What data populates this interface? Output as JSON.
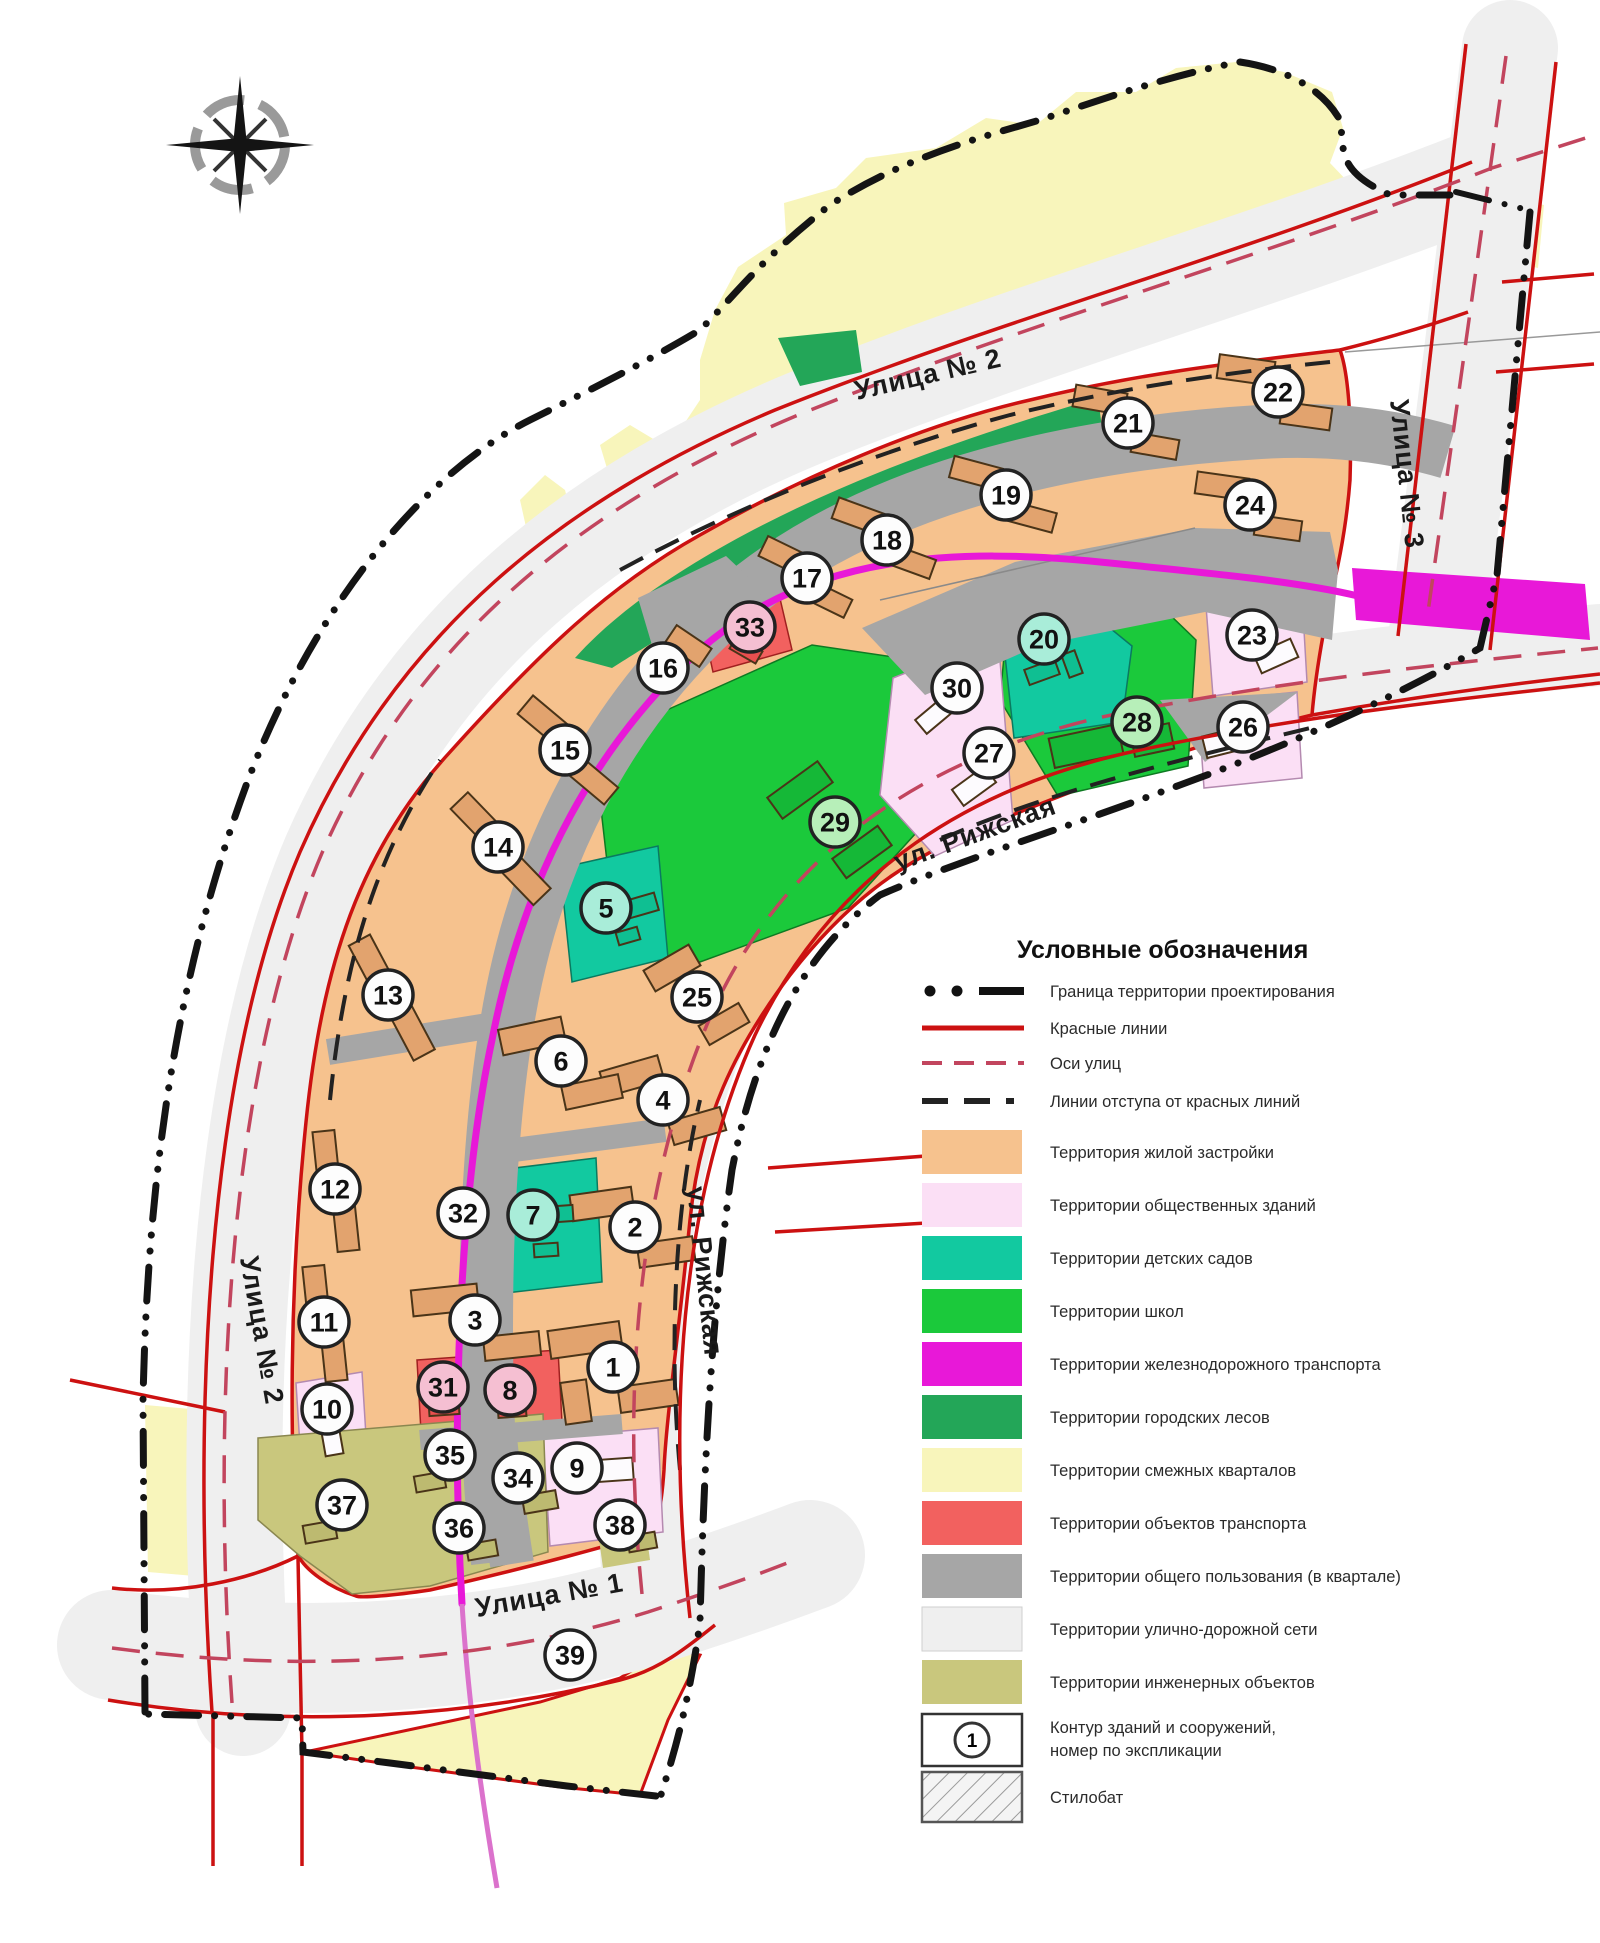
{
  "page": {
    "type": "urban-planning-scheme"
  },
  "colors": {
    "red_line": "#CC1111",
    "street_axis": "#C2455E",
    "boundary": "#141414",
    "residential": "#F6C28E",
    "public_buildings": "#FBDFF5",
    "kindergartens": "#12C9A0",
    "schools": "#1BC93B",
    "railway": "#E818D8",
    "urban_forests": "#23A658",
    "adjacent_blocks": "#F8F5BB",
    "transport_objects": "#F2615F",
    "common_use": "#A6A6A6",
    "street_network": "#EFEFEF",
    "engineering": "#C9C77D"
  },
  "map": {
    "street_labels": [
      {
        "text": "Улица № 2",
        "x": 930,
        "y": 383,
        "rot": -13
      },
      {
        "text": "Улица № 3",
        "x": 1398,
        "y": 475,
        "rot": 84
      },
      {
        "text": "ул. Рижская",
        "x": 978,
        "y": 842,
        "rot": -20
      },
      {
        "text": "ул. Рижская",
        "x": 696,
        "y": 1272,
        "rot": 84
      },
      {
        "text": "Улица № 2",
        "x": 253,
        "y": 1332,
        "rot": 80
      },
      {
        "text": "Улица № 1",
        "x": 551,
        "y": 1604,
        "rot": -10
      }
    ],
    "blocks": [
      {
        "n": "1",
        "x": 613,
        "y": 1367,
        "fill": "w"
      },
      {
        "n": "2",
        "x": 635,
        "y": 1227,
        "fill": "w"
      },
      {
        "n": "3",
        "x": 475,
        "y": 1320,
        "fill": "w"
      },
      {
        "n": "4",
        "x": 663,
        "y": 1100,
        "fill": "w"
      },
      {
        "n": "5",
        "x": 606,
        "y": 908,
        "fill": "t"
      },
      {
        "n": "6",
        "x": 561,
        "y": 1061,
        "fill": "w"
      },
      {
        "n": "7",
        "x": 533,
        "y": 1215,
        "fill": "t"
      },
      {
        "n": "8",
        "x": 510,
        "y": 1390,
        "fill": "p"
      },
      {
        "n": "9",
        "x": 577,
        "y": 1468,
        "fill": "w"
      },
      {
        "n": "10",
        "x": 327,
        "y": 1409,
        "fill": "w"
      },
      {
        "n": "11",
        "x": 324,
        "y": 1322,
        "fill": "w"
      },
      {
        "n": "12",
        "x": 335,
        "y": 1189,
        "fill": "w"
      },
      {
        "n": "13",
        "x": 388,
        "y": 995,
        "fill": "w"
      },
      {
        "n": "14",
        "x": 498,
        "y": 847,
        "fill": "w"
      },
      {
        "n": "15",
        "x": 565,
        "y": 750,
        "fill": "w"
      },
      {
        "n": "16",
        "x": 663,
        "y": 668,
        "fill": "w"
      },
      {
        "n": "17",
        "x": 807,
        "y": 578,
        "fill": "w"
      },
      {
        "n": "18",
        "x": 887,
        "y": 540,
        "fill": "w"
      },
      {
        "n": "19",
        "x": 1006,
        "y": 495,
        "fill": "w"
      },
      {
        "n": "20",
        "x": 1044,
        "y": 639,
        "fill": "t"
      },
      {
        "n": "21",
        "x": 1128,
        "y": 423,
        "fill": "w"
      },
      {
        "n": "22",
        "x": 1278,
        "y": 392,
        "fill": "w"
      },
      {
        "n": "23",
        "x": 1252,
        "y": 635,
        "fill": "w"
      },
      {
        "n": "24",
        "x": 1250,
        "y": 505,
        "fill": "w"
      },
      {
        "n": "25",
        "x": 697,
        "y": 997,
        "fill": "w"
      },
      {
        "n": "26",
        "x": 1243,
        "y": 727,
        "fill": "w"
      },
      {
        "n": "27",
        "x": 989,
        "y": 753,
        "fill": "w"
      },
      {
        "n": "28",
        "x": 1137,
        "y": 722,
        "fill": "g"
      },
      {
        "n": "29",
        "x": 835,
        "y": 822,
        "fill": "g"
      },
      {
        "n": "30",
        "x": 957,
        "y": 688,
        "fill": "w"
      },
      {
        "n": "31",
        "x": 443,
        "y": 1387,
        "fill": "p"
      },
      {
        "n": "32",
        "x": 463,
        "y": 1213,
        "fill": "w"
      },
      {
        "n": "33",
        "x": 750,
        "y": 627,
        "fill": "p"
      },
      {
        "n": "34",
        "x": 518,
        "y": 1478,
        "fill": "w"
      },
      {
        "n": "35",
        "x": 450,
        "y": 1455,
        "fill": "w"
      },
      {
        "n": "36",
        "x": 459,
        "y": 1528,
        "fill": "w"
      },
      {
        "n": "37",
        "x": 342,
        "y": 1505,
        "fill": "w"
      },
      {
        "n": "38",
        "x": 620,
        "y": 1525,
        "fill": "w"
      },
      {
        "n": "39",
        "x": 570,
        "y": 1655,
        "fill": "w"
      }
    ]
  },
  "legend": {
    "title": "Условные обозначения",
    "lines": [
      {
        "name": "project-boundary-line",
        "label": "Граница территории проектирования"
      },
      {
        "name": "red-lines",
        "label": "Красные линии"
      },
      {
        "name": "street-axes",
        "label": "Оси улиц"
      },
      {
        "name": "setback-lines",
        "label": "Линии отступа от красных линий"
      }
    ],
    "areas": [
      {
        "name": "residential",
        "label": "Территория жилой застройки",
        "color": "#F6C28E"
      },
      {
        "name": "public-buildings",
        "label": "Территории общественных зданий",
        "color": "#FBDFF5"
      },
      {
        "name": "kindergartens",
        "label": "Территории детских садов",
        "color": "#12C9A0"
      },
      {
        "name": "schools",
        "label": "Территории школ",
        "color": "#1BC93B"
      },
      {
        "name": "railway-transport",
        "label": "Территории железнодорожного транспорта",
        "color": "#E818D8"
      },
      {
        "name": "urban-forests",
        "label": "Территории городских лесов",
        "color": "#23A658"
      },
      {
        "name": "adjacent-blocks",
        "label": "Территории смежных кварталов",
        "color": "#F8F5BB"
      },
      {
        "name": "transport-objects",
        "label": "Территории объектов транспорта",
        "color": "#F2615F"
      },
      {
        "name": "common-use",
        "label": "Территории общего пользования (в квартале)",
        "color": "#A6A6A6"
      },
      {
        "name": "street-network",
        "label": "Территории улично-дорожной сети",
        "color": "#EFEFEF"
      },
      {
        "name": "engineering",
        "label": "Территории инженерных объектов",
        "color": "#C9C77D"
      }
    ],
    "contour": {
      "label_line1": "Контур зданий и сооружений,",
      "label_line2": "номер по экспликации",
      "number": "1"
    },
    "stylobate": {
      "label": "Стилобат"
    }
  }
}
